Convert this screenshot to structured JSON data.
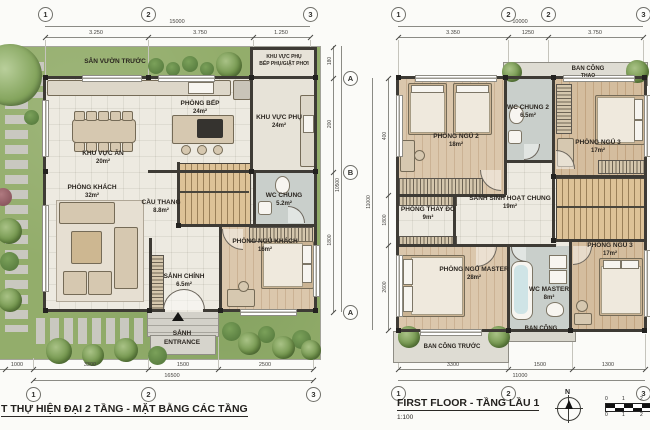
{
  "gf": {
    "bubbles_top": [
      "1",
      "2",
      "3"
    ],
    "dim_top_total": "15000",
    "dim_top_segs": [
      "3.250",
      "3.750",
      "1.250"
    ],
    "garden_front": "SÂN VƯỜN TRƯỚC",
    "annex": {
      "l1": "KHU VỰC PHỤ",
      "l2": "BẾP PHỤ/GIẶT PHƠI"
    },
    "kitchen": {
      "name": "PHÒNG BẾP",
      "area": "24m²"
    },
    "aux": {
      "name": "KHU VỰC PHỤ",
      "area": "24m²"
    },
    "dining": {
      "name": "KHU VỰC ĂN",
      "area": "20m²"
    },
    "living": {
      "name": "PHÒNG KHÁCH",
      "area": "32m²"
    },
    "stairs": {
      "name": "CẦU THANG",
      "area": "8.8m²"
    },
    "wc": {
      "name": "WC CHUNG",
      "area": "5.2m²"
    },
    "guest": {
      "name": "PHÒNG NGỦ KHÁCH",
      "area": "16m²"
    },
    "lobby": {
      "name": "SẢNH CHÍNH",
      "area": "6.5m²"
    },
    "entrance": {
      "l1": "SẢNH",
      "l2": "ENTRANCE"
    },
    "dim_bottom_segs": [
      "1000",
      "3300",
      "1500",
      "2500"
    ],
    "dim_bottom_total": "16500",
    "bubbles_bottom": [
      "1",
      "2",
      "3"
    ],
    "side": {
      "bubbles": [
        "A",
        "B",
        "A"
      ],
      "segs": [
        "180",
        "200",
        "1800"
      ],
      "total": "10500"
    },
    "title": "T THỰ HIỆN ĐẠI 2 TẦNG - MẶT BẰNG CÁC TẦNG"
  },
  "ff": {
    "bubbles_top": [
      "1",
      "2",
      "2",
      "3"
    ],
    "dim_top_total": "10000",
    "dim_top_segs": [
      "3.350",
      "1250",
      "3.750"
    ],
    "balcony_top": {
      "l1": "BAN CÔNG",
      "l2": "THAO"
    },
    "bed2": {
      "name": "PHÒNG NGỦ 2",
      "area": "18m²"
    },
    "wc2": {
      "name": "WC CHUNG 2",
      "area": "6.5m²"
    },
    "bed3a": {
      "name": "PHÒNG NGỦ 3",
      "area": "17m²"
    },
    "dressing": {
      "name": "PHÒNG THAY ĐỒ",
      "area": "9m²"
    },
    "hall": {
      "name": "SẢNH SINH HOẠT CHUNG",
      "area": "19m²"
    },
    "master": {
      "name": "PHÒNG NGỦ MASTER",
      "area": "28m²"
    },
    "wcm": {
      "name": "WC MASTER",
      "area": "8m²"
    },
    "bed3b": {
      "name": "PHÒNG NGỦ 3",
      "area": "17m²"
    },
    "balcony_front": "BAN CÔNG TRƯỚC",
    "balcony_small": "BAN CÔNG",
    "side": {
      "segs": [
        "400",
        "1800",
        "2600"
      ],
      "total": "11000"
    },
    "dim_bottom_segs": [
      "3300",
      "1500",
      "1300"
    ],
    "dim_bottom_total": "11000",
    "bubbles_bottom": [
      "1",
      "2",
      "3"
    ],
    "title": "FIRST FLOOR - TẦNG LẦU 1",
    "scale": "1:100",
    "north": "N",
    "scalebar": {
      "top": [
        "0",
        "1",
        "2"
      ],
      "bottom": [
        "0",
        "1",
        "2"
      ]
    }
  },
  "colors": {
    "wall": "#3e3b35",
    "grass": "#93ad6b",
    "wood": "#d4bd9e",
    "wc": "#c9cfcb",
    "slab": "#dedcd3"
  }
}
